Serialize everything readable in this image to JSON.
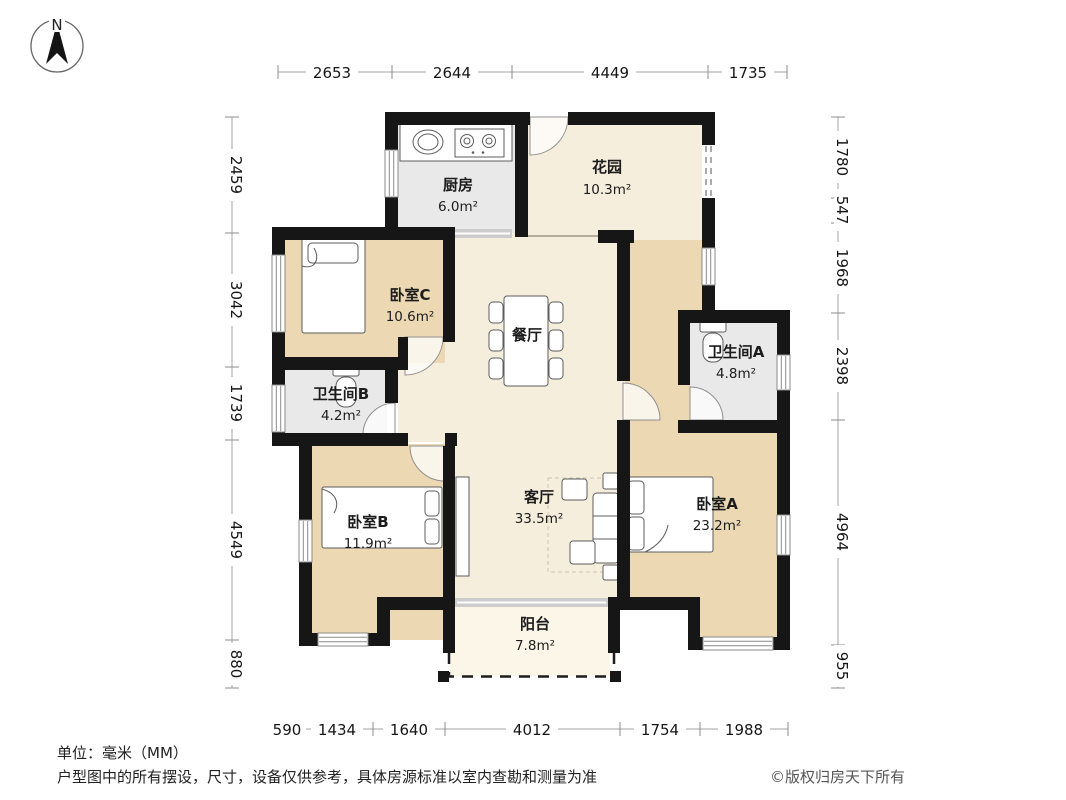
{
  "compass": {
    "label": "N"
  },
  "rooms": [
    {
      "id": "kitchen",
      "name": "厨房",
      "area": "6.0m²"
    },
    {
      "id": "garden",
      "name": "花园",
      "area": "10.3m²"
    },
    {
      "id": "bedroom-c",
      "name": "卧室C",
      "area": "10.6m²"
    },
    {
      "id": "dining",
      "name": "餐厅",
      "area": ""
    },
    {
      "id": "bathroom-a",
      "name": "卫生间A",
      "area": "4.8m²"
    },
    {
      "id": "bathroom-b",
      "name": "卫生间B",
      "area": "4.2m²"
    },
    {
      "id": "bedroom-b",
      "name": "卧室B",
      "area": "11.9m²"
    },
    {
      "id": "living",
      "name": "客厅",
      "area": "33.5m²"
    },
    {
      "id": "bedroom-a",
      "name": "卧室A",
      "area": "23.2m²"
    },
    {
      "id": "balcony",
      "name": "阳台",
      "area": "7.8m²"
    }
  ],
  "dimensions": {
    "unit": "mm",
    "top": [
      "2653",
      "2644",
      "4449",
      "1735"
    ],
    "left": [
      "2459",
      "3042",
      "1739",
      "4549",
      "880"
    ],
    "right": [
      "1780",
      "547",
      "1968",
      "2398",
      "4964",
      "955"
    ],
    "bottom": [
      "590",
      "1434",
      "1640",
      "4012",
      "1754",
      "1988"
    ]
  },
  "footer": {
    "unit": "单位：毫米（MM）",
    "disclaimer": "户型图中的所有摆设，尺寸，设备仅供参考，具体房源标准以室内查勘和测量为准",
    "copyright": "©版权归房天下所有"
  },
  "colors": {
    "wall": "#161616",
    "bedroom": "#ecd9b3",
    "living": "#f6eedd",
    "wet": "#e9e9e9",
    "balcony": "#fcf6e8",
    "garden": "#f6eedd"
  }
}
